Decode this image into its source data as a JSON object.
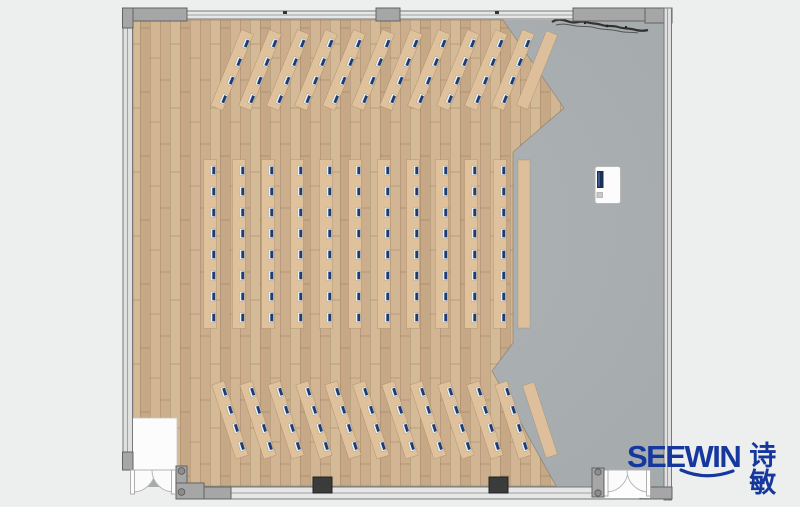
{
  "page": {
    "background": "#edeeee"
  },
  "floorplan": {
    "description": "training-room floor plan, top view",
    "colors": {
      "page_bg": "#edeeee",
      "concrete": "#a9aeb0",
      "wood_a": "#ccae8d",
      "wood_b": "#d5ba97",
      "wood_c": "#c7a886",
      "wood_d": "#d2b693",
      "desk": "#dfc29c",
      "bench": "#ddc09b",
      "monitor_navy": "#1e3c74",
      "monitor_white": "#eef0ec",
      "podium_white": "#fcfcfc",
      "brand": "#16389d"
    },
    "monitor": {
      "w": 5,
      "h": 10,
      "inner_w": 2.8,
      "inner_h": 7.6,
      "offset_x": 3
    },
    "sections": [
      {
        "name": "front-angled-rows",
        "angle": 22,
        "desk_length": 82,
        "desk_width": 13,
        "seats": 4,
        "seat_spacing": 20,
        "center_y": 70,
        "desk_centers_x": [
          232,
          260,
          288,
          316,
          344,
          373,
          401,
          429,
          458,
          486,
          513
        ],
        "bench_center_x": 537,
        "bench_length": 80,
        "bench_width": 12
      },
      {
        "name": "middle-straight-rows",
        "angle": 0,
        "desk_length": 169,
        "desk_width": 13,
        "seats": 8,
        "seat_spacing": 21,
        "center_y": 244,
        "desk_centers_x": [
          210,
          239,
          268,
          297,
          326,
          355,
          384,
          413,
          442,
          471,
          500
        ],
        "bench_center_x": 524,
        "bench_length": 168,
        "bench_width": 12
      },
      {
        "name": "back-angled-rows",
        "angle": -18,
        "desk_length": 78,
        "desk_width": 13,
        "seats": 4,
        "seat_spacing": 19,
        "center_y": 420,
        "desk_centers_x": [
          230,
          258,
          286,
          314,
          343,
          371,
          400,
          428,
          456,
          485,
          513
        ],
        "bench_center_x": 540,
        "bench_length": 76,
        "bench_width": 12
      }
    ],
    "summary": {
      "desk_rows_with_monitors": 33,
      "plain_side_benches": 3,
      "monitor_marks_total": 176,
      "podium_count": 1,
      "double_doors": 2
    }
  },
  "logo": {
    "brand_latin": "SEEWIN",
    "brand_cn": "诗敏",
    "color": "#16389d"
  }
}
